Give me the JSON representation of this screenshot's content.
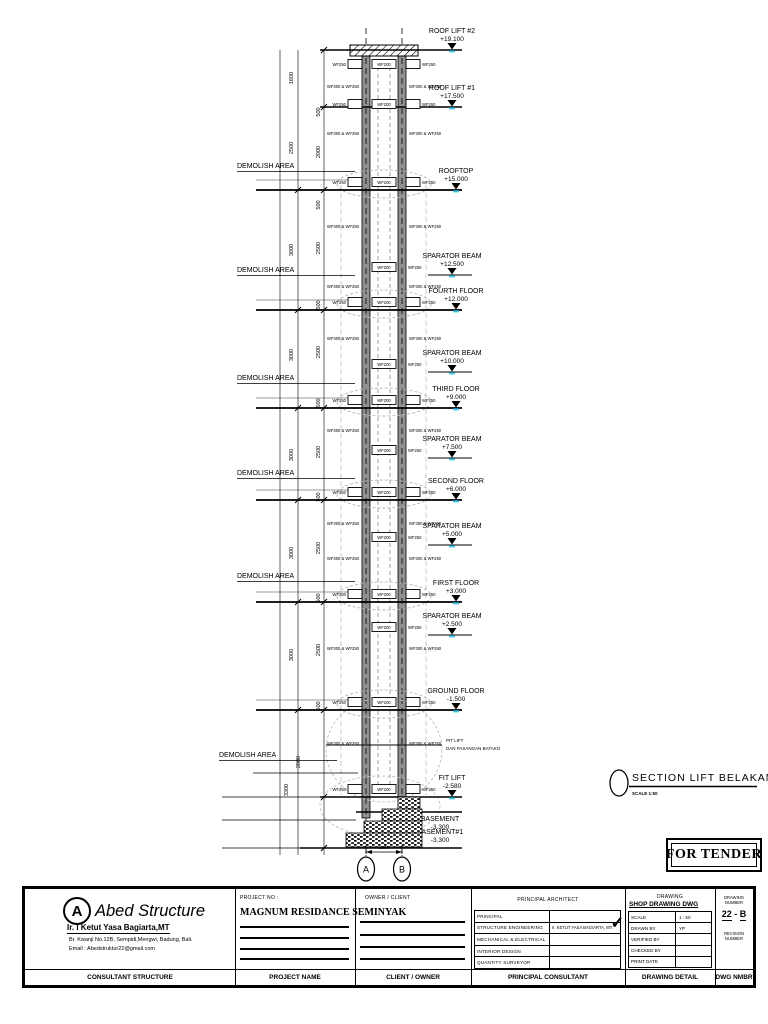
{
  "drawing": {
    "section_title": "SECTION LIFT BELAKANG",
    "section_scale": "SCALE 1:50",
    "pit_note_line1": "PIT LIFT",
    "pit_note_line2": "DAN PASANGAN BATAKO",
    "demolish_label": "DEMOLISH AREA",
    "demolish_positions": [
      [
        237,
        168
      ],
      [
        237,
        272
      ],
      [
        237,
        380
      ],
      [
        237,
        475
      ],
      [
        237,
        578
      ],
      [
        219,
        757
      ]
    ],
    "beam_inner_label": "WF200",
    "beam_flange_label": "WF250",
    "wall_label": "WF300 & WF250",
    "grid_bubbles": [
      "A",
      "B"
    ],
    "grid_dim": "1800",
    "levels": [
      {
        "name": "ROOF LIFT #2",
        "elev": "+19.100",
        "x": 452,
        "y": 50,
        "x1": 320,
        "x2": 462,
        "w": 1.4,
        "m": 1
      },
      {
        "name": "ROOF LIFT #1",
        "elev": "+17.500",
        "x": 452,
        "y": 107,
        "x1": 320,
        "x2": 462,
        "w": 1.4,
        "m": 1
      },
      {
        "name": "ROOFTOP",
        "elev": "+15.000",
        "x": 456,
        "y": 190,
        "x1": 256,
        "x2": 462,
        "w": 1.7,
        "m": 1
      },
      {
        "name": "SPARATOR BEAM",
        "elev": "+12.500",
        "x": 452,
        "y": 275,
        "x1": 428,
        "x2": 472,
        "w": 1.1,
        "m": 1
      },
      {
        "name": "FOURTH FLOOR",
        "elev": "+12.000",
        "x": 456,
        "y": 310,
        "x1": 256,
        "x2": 462,
        "w": 1.7,
        "m": 1
      },
      {
        "name": "SPARATOR BEAM",
        "elev": "+10.000",
        "x": 452,
        "y": 372,
        "x1": 428,
        "x2": 472,
        "w": 1.1,
        "m": 1
      },
      {
        "name": "THIRD FLOOR",
        "elev": "+9.000",
        "x": 456,
        "y": 408,
        "x1": 256,
        "x2": 462,
        "w": 1.7,
        "m": 1
      },
      {
        "name": "SPARATOR BEAM",
        "elev": "+7.500",
        "x": 452,
        "y": 458,
        "x1": 428,
        "x2": 472,
        "w": 1.1,
        "m": 1
      },
      {
        "name": "SECOND FLOOR",
        "elev": "+6.000",
        "x": 456,
        "y": 500,
        "x1": 256,
        "x2": 462,
        "w": 1.7,
        "m": 1
      },
      {
        "name": "SPARATOR BEAM",
        "elev": "+5.000",
        "x": 452,
        "y": 545,
        "x1": 428,
        "x2": 472,
        "w": 1.1,
        "m": 1
      },
      {
        "name": "FIRST FLOOR",
        "elev": "+3.000",
        "x": 456,
        "y": 602,
        "x1": 256,
        "x2": 462,
        "w": 1.7,
        "m": 1
      },
      {
        "name": "SPARATOR BEAM",
        "elev": "+2.500",
        "x": 452,
        "y": 635,
        "x1": 428,
        "x2": 472,
        "w": 1.1,
        "m": 1
      },
      {
        "name": "GROUND FLOOR",
        "elev": "-1.500",
        "x": 456,
        "y": 710,
        "x1": 256,
        "x2": 462,
        "w": 1.7,
        "m": 1
      },
      {
        "name": "FIT LIFT",
        "elev": "-2.580",
        "x": 452,
        "y": 797,
        "x1": 320,
        "x2": 462,
        "w": 1.4,
        "m": 1
      },
      {
        "name": "BASEMENT",
        "elev": "-3.300",
        "x": 440,
        "y": 812,
        "x1": 356,
        "x2": 462,
        "w": 1.4,
        "m": 0,
        "below": true
      },
      {
        "name": "BASEMENT#1",
        "elev": "-3.300",
        "x": 440,
        "y": 848,
        "x1": 300,
        "x2": 462,
        "w": 1.4,
        "m": 0
      }
    ],
    "dims": [
      [
        293,
        78,
        "1600"
      ],
      [
        320,
        112,
        "500"
      ],
      [
        293,
        148,
        "2500"
      ],
      [
        320,
        152,
        "2000"
      ],
      [
        320,
        205,
        "500"
      ],
      [
        293,
        250,
        "3000"
      ],
      [
        320,
        248,
        "2500"
      ],
      [
        320,
        305,
        "500"
      ],
      [
        293,
        355,
        "3000"
      ],
      [
        320,
        352,
        "2500"
      ],
      [
        320,
        403,
        "500"
      ],
      [
        293,
        455,
        "3000"
      ],
      [
        320,
        452,
        "2500"
      ],
      [
        320,
        497,
        "500"
      ],
      [
        293,
        553,
        "3000"
      ],
      [
        320,
        548,
        "2500"
      ],
      [
        320,
        598,
        "500"
      ],
      [
        293,
        655,
        "3000"
      ],
      [
        320,
        650,
        "2500"
      ],
      [
        320,
        706,
        "500"
      ],
      [
        300,
        762,
        "2000"
      ],
      [
        288,
        790,
        "3300"
      ]
    ],
    "beam_rows": [
      [
        64,
        1
      ],
      [
        104,
        1
      ],
      [
        182,
        1
      ],
      [
        267,
        0
      ],
      [
        302,
        1
      ],
      [
        364,
        0
      ],
      [
        400,
        1
      ],
      [
        450,
        0
      ],
      [
        492,
        1
      ],
      [
        537,
        0
      ],
      [
        594,
        1
      ],
      [
        627,
        0
      ],
      [
        702,
        1
      ],
      [
        789,
        1
      ]
    ],
    "wall_label_rows": [
      88,
      135,
      228,
      288,
      340,
      432,
      525,
      560,
      650,
      745
    ],
    "accent_color": "#45c6ea"
  },
  "stamp": {
    "label": "FOR TENDER"
  },
  "titleblock": {
    "consultant": {
      "logo_letter": "A",
      "company": "Abed Structure",
      "principal": "Ir. I Ketut Yasa Bagiarta,MT",
      "address": "Br. Kwanji No.12B, Sempidi,Mengwi, Badung, Bali.",
      "email": "Email : Abedstruktur22@gmail.com",
      "footer": "CONSULTANT STRUCTURE"
    },
    "project": {
      "label": "PROJECT NO :",
      "name": "MAGNUM RESIDANCE SEMINYAK",
      "footer": "PROJECT NAME"
    },
    "client": {
      "label": "OWNER / CLIENT",
      "footer": "CLIENT / OWNER"
    },
    "consultants": {
      "label": "PRINCIPAL ARCHITECT",
      "rows": [
        "PRINCIPAL",
        "STRUCTURE ENGINEERING",
        "MECHANICAL & ELECTRICAL",
        "INTERIOR DESIGN",
        "QUANTITY SURVEYOR"
      ],
      "structure_value": "Ir. KETUT YASA BAGIARTA, MT.",
      "check_mark": "✓",
      "footer": "PRINCIPAL CONSULTANT"
    },
    "drawing_info": {
      "label": "DRAWING",
      "type": "SHOP DRAWING DWG",
      "rows": [
        [
          "SCALE",
          "1 : 50"
        ],
        [
          "DRAWN BY",
          "YP"
        ],
        [
          "VERIFIED BY",
          ""
        ],
        [
          "CHECKED BY",
          ""
        ],
        [
          "PRINT DATE",
          ""
        ]
      ],
      "footer": "DRAWING DETAIL"
    },
    "number": {
      "label": "DRAWING NUMBER",
      "value_left": "22",
      "value_sep": " - ",
      "value_right": "B",
      "revision_label": "REVISION NUMBER",
      "footer": "DWG NMBR"
    }
  }
}
